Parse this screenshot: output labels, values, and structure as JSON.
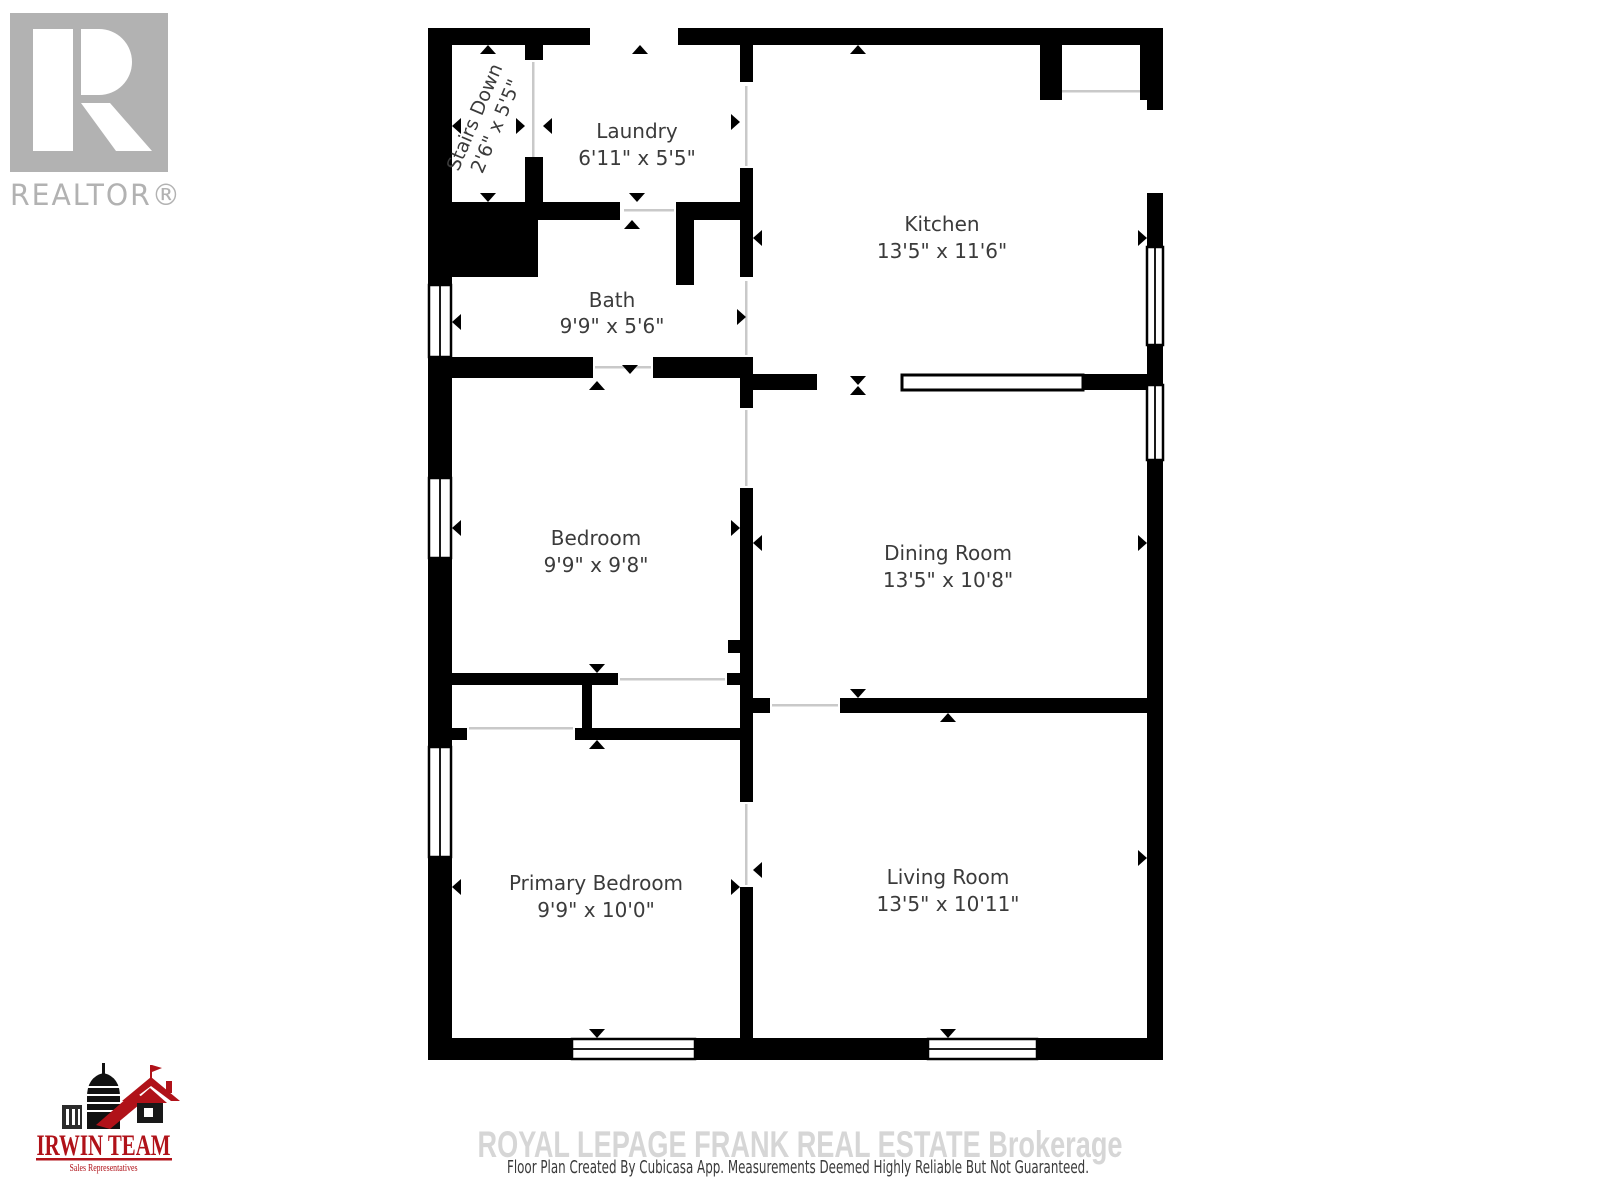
{
  "page": {
    "background": "#ffffff"
  },
  "branding": {
    "realtor": {
      "letter": "R",
      "label": "REALTOR®"
    },
    "irwin": {
      "title": "IRWIN TEAM",
      "subtitle": "Sales Representatives"
    }
  },
  "rooms": {
    "stairs": {
      "name": "Stairs Down",
      "dims": "2'6\" x 5'5\""
    },
    "laundry": {
      "name": "Laundry",
      "dims": "6'11\" x 5'5\""
    },
    "kitchen": {
      "name": "Kitchen",
      "dims": "13'5\" x 11'6\""
    },
    "bath": {
      "name": "Bath",
      "dims": "9'9\" x 5'6\""
    },
    "bedroom": {
      "name": "Bedroom",
      "dims": "9'9\" x 9'8\""
    },
    "dining": {
      "name": "Dining Room",
      "dims": "13'5\" x 10'8\""
    },
    "primary": {
      "name": "Primary Bedroom",
      "dims": "9'9\" x 10'0\""
    },
    "living": {
      "name": "Living Room",
      "dims": "13'5\" x 10'11\""
    }
  },
  "footer": {
    "watermark": "ROYAL LEPAGE FRANK REAL ESTATE  Brokerage",
    "disclaimer": "Floor Plan Created By Cubicasa App. Measurements Deemed Highly Reliable But Not Guaranteed."
  },
  "colors": {
    "wall": "#000000",
    "label": "#3b3b3b",
    "watermark": "#d6d6d6",
    "disclaimer": "#3a3a3a",
    "brand_red": "#b01219",
    "logo_gray": "#b2b2b2"
  }
}
